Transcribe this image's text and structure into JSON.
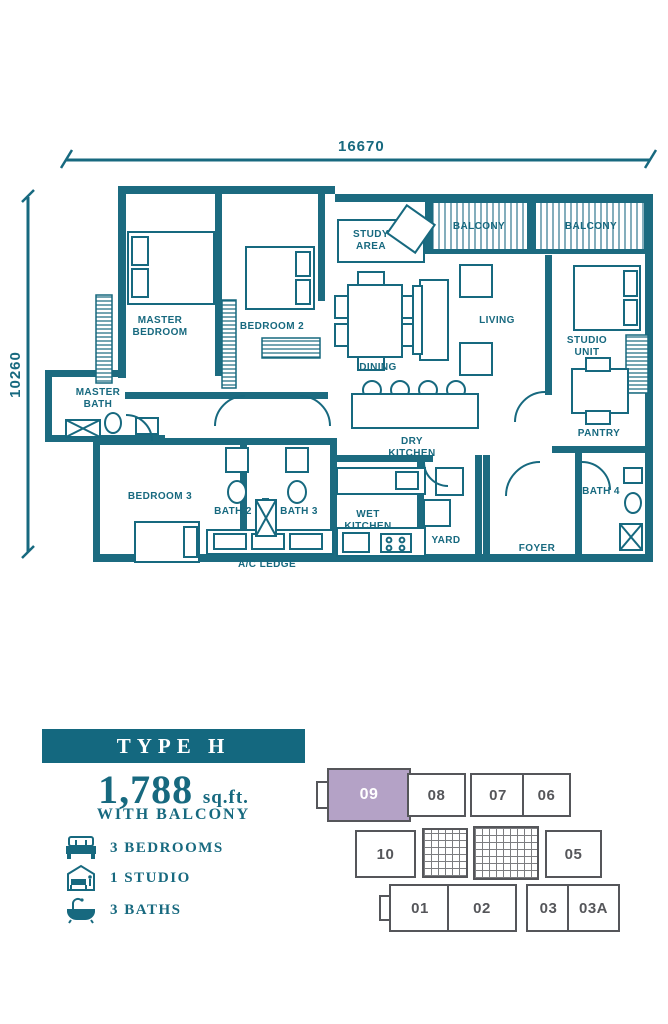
{
  "colors": {
    "accent_teal": "#17697f",
    "banner_teal": "#14687f",
    "highlight_lavender": "#b4a2c6",
    "keyplan_gray": "#55565a"
  },
  "dimensions": {
    "top": "16670",
    "left": "10260"
  },
  "floorplan": {
    "rooms": {
      "master_bedroom": "MASTER BEDROOM",
      "bedroom2": "BEDROOM 2",
      "bedroom3": "BEDROOM 3",
      "study_area": "STUDY AREA",
      "balcony1": "BALCONY",
      "balcony2": "BALCONY",
      "living": "LIVING",
      "dining": "DINING",
      "studio_unit": "STUDIO UNIT",
      "pantry": "PANTRY",
      "master_bath": "MASTER BATH",
      "dry_kitchen": "DRY KITCHEN",
      "wet_kitchen": "WET KITCHEN",
      "bath2": "BATH 2",
      "bath3": "BATH 3",
      "bath4": "BATH 4",
      "yard": "YARD",
      "foyer": "FOYER",
      "ac_ledge": "A/C LEDGE"
    }
  },
  "unit_info": {
    "type_label": "TYPE H",
    "area_value": "1,788",
    "area_unit": "sq.ft.",
    "area_note": "WITH BALCONY",
    "features": [
      {
        "icon": "bed-icon",
        "label": "3 BEDROOMS"
      },
      {
        "icon": "studio-icon",
        "label": "1 STUDIO"
      },
      {
        "icon": "bath-icon",
        "label": "3 BATHS"
      }
    ]
  },
  "keyplan": {
    "units": [
      {
        "label": "09",
        "highlighted": true
      },
      {
        "label": "08",
        "highlighted": false
      },
      {
        "label": "07",
        "highlighted": false
      },
      {
        "label": "06",
        "highlighted": false
      },
      {
        "label": "10",
        "highlighted": false
      },
      {
        "label": "05",
        "highlighted": false
      },
      {
        "label": "01",
        "highlighted": false
      },
      {
        "label": "02",
        "highlighted": false
      },
      {
        "label": "03",
        "highlighted": false
      },
      {
        "label": "03A",
        "highlighted": false
      }
    ]
  }
}
